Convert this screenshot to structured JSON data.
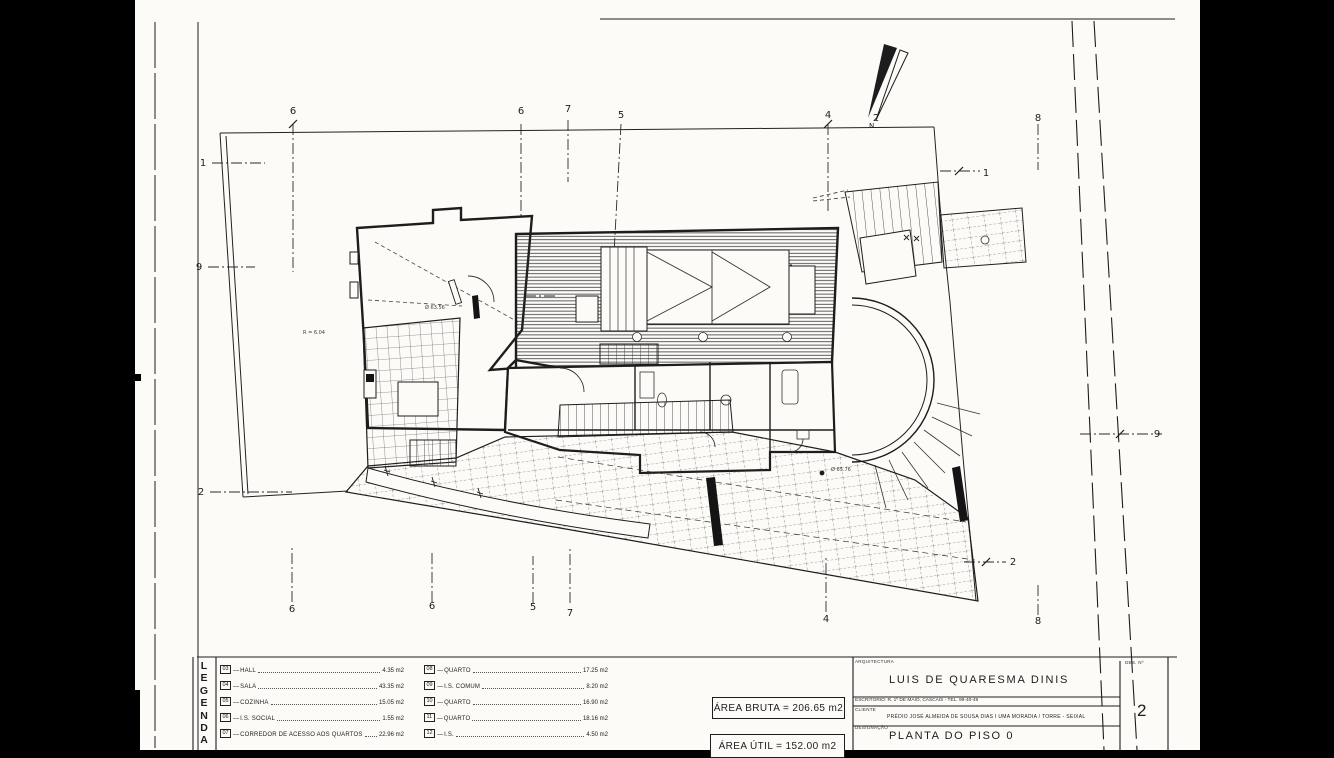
{
  "legend": {
    "header_letters": [
      "L",
      "E",
      "G",
      "E",
      "N",
      "D",
      "A"
    ],
    "left_items": [
      {
        "code": "03",
        "name": "HALL",
        "area": "4.35 m2"
      },
      {
        "code": "04",
        "name": "SALA",
        "area": "43.35 m2"
      },
      {
        "code": "05",
        "name": "COZINHA",
        "area": "15.05 m2"
      },
      {
        "code": "06",
        "name": "I.S. SOCIAL",
        "area": "1.55 m2"
      },
      {
        "code": "07",
        "name": "CORREDOR DE ACESSO AOS QUARTOS",
        "area": "22.96 m2"
      }
    ],
    "right_items": [
      {
        "code": "08",
        "name": "QUARTO",
        "area": "17.25 m2"
      },
      {
        "code": "09",
        "name": "I.S. COMUM",
        "area": "8.20 m2"
      },
      {
        "code": "10",
        "name": "QUARTO",
        "area": "16.90 m2"
      },
      {
        "code": "11",
        "name": "QUARTO",
        "area": "18.16 m2"
      },
      {
        "code": "12",
        "name": "I.S.",
        "area": "4.50 m2"
      }
    ]
  },
  "areas": {
    "bruta": "ÁREA BRUTA = 206.65 m2",
    "util": "ÁREA ÚTIL = 152.00 m2"
  },
  "title_block": {
    "section_label": "ARQUITECTURA",
    "architect": "LUIS DE QUARESMA DINIS",
    "office_line": "ESCRITÓRIO: R. 1º DE MAIO, CASCAIS - TEL. 99-40-49",
    "client_label": "CLIENTE",
    "client_line": "PRÉDIO JOSÉ ALMEIDA DE SOUSA DIAS I UMA MORADIA / TORRE - SEIXAL",
    "designation_label": "DESIGNAÇÃO",
    "designation": "PLANTA DO PISO 0",
    "sheet_no_label": "DES. Nº",
    "sheet_no": "2"
  },
  "plan": {
    "north_label": "N",
    "markers": [
      {
        "label": "6",
        "x": 293,
        "y": 114
      },
      {
        "label": "6",
        "x": 521,
        "y": 114
      },
      {
        "label": "7",
        "x": 568,
        "y": 112
      },
      {
        "label": "5",
        "x": 621,
        "y": 118
      },
      {
        "label": "4",
        "x": 828,
        "y": 118
      },
      {
        "label": "2",
        "x": 876,
        "y": 121
      },
      {
        "label": "8",
        "x": 1038,
        "y": 121
      },
      {
        "label": "6",
        "x": 292,
        "y": 612
      },
      {
        "label": "6",
        "x": 432,
        "y": 609
      },
      {
        "label": "5",
        "x": 533,
        "y": 610
      },
      {
        "label": "7",
        "x": 570,
        "y": 616
      },
      {
        "label": "4",
        "x": 826,
        "y": 622
      },
      {
        "label": "8",
        "x": 1038,
        "y": 624
      },
      {
        "label": "1",
        "x": 203,
        "y": 166
      },
      {
        "label": "9",
        "x": 199,
        "y": 270
      },
      {
        "label": "2",
        "x": 201,
        "y": 495
      },
      {
        "label": "1",
        "x": 986,
        "y": 176
      },
      {
        "label": "9",
        "x": 1157,
        "y": 437
      },
      {
        "label": "2",
        "x": 1013,
        "y": 565
      }
    ],
    "annotations": [
      {
        "text": "R = 6.04",
        "x": 303,
        "y": 334
      },
      {
        "text": "Ø 63.56",
        "x": 425,
        "y": 309
      },
      {
        "text": "Ø 65.76",
        "x": 831,
        "y": 471
      }
    ]
  },
  "colors": {
    "ink": "#1d1d1d",
    "paper": "#fcfbf8",
    "letterbox": "#000000"
  }
}
